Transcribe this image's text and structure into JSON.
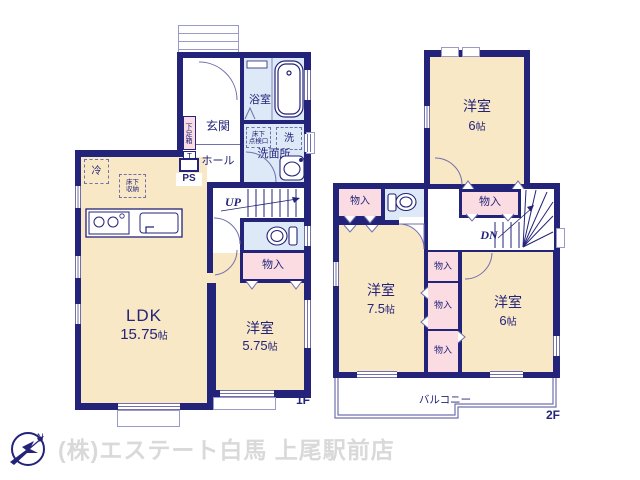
{
  "footer": {
    "company": "(株)エステート白馬 上尾駅前店"
  },
  "compass": {
    "north": "N"
  },
  "floor1": {
    "tag": "1F",
    "ldk": {
      "name": "LDK",
      "size": "15.75",
      "unit": "帖"
    },
    "bedroom": {
      "name": "洋室",
      "size": "5.75",
      "unit": "帖"
    },
    "genkan": "玄関",
    "hall": "ホール",
    "bath": "浴室",
    "washroom": "洗面所",
    "washer": "洗",
    "inspection_l1": "床下",
    "inspection_l2": "点検口",
    "shoebox": "下足箱",
    "shoebox_t": "T",
    "ps": "PS",
    "up": "UP",
    "closet": "物入",
    "fridge": "冷",
    "storage_l1": "床下",
    "storage_l2": "収納"
  },
  "floor2": {
    "tag": "2F",
    "bedroom1": {
      "name": "洋室",
      "size": "6",
      "unit": "帖"
    },
    "bedroom2": {
      "name": "洋室",
      "size": "7.5",
      "unit": "帖"
    },
    "bedroom3": {
      "name": "洋室",
      "size": "6",
      "unit": "帖"
    },
    "closet": "物入",
    "dn": "DN",
    "balcony": "バルコニー"
  }
}
